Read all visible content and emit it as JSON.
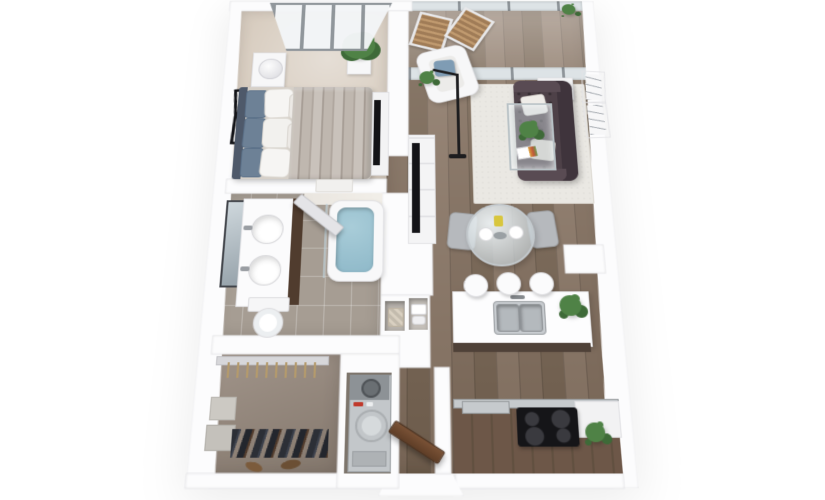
{
  "meta": {
    "description": "3D top-down floor plan rendering of a one-bedroom, one-bathroom apartment with balcony, walk-in closet, in-unit laundry and open kitchen-living area",
    "view": "bird's-eye 3D render on white background",
    "units_text_visible": "none"
  },
  "colors": {
    "wall": "#fcfcfd",
    "walledge": "#e4e4e8",
    "carpet": "#d8cdc0",
    "wood": "#84705f",
    "woodplank": "#796654",
    "woodlight": "#8d7968",
    "tile": "#a69d93",
    "closetfloor": "#94867a",
    "laundryfloor": "#7d756c",
    "rug": "#eae8e3",
    "sofa": "#4e4148",
    "sofaback": "#3f343c",
    "sofaarm": "#594b53",
    "pillowblue": "#7f9cb4",
    "water": "#8fb9c9",
    "vanity": "#503c2e",
    "counterwood": "#6d5748",
    "counterplank": "#615040",
    "cooktop": "#151518",
    "steel": "#c6cacd",
    "plant": "#4f8246",
    "plantdark": "#3e6a38",
    "doorwood": "#6e4a2f",
    "washer": "#c3c7ca",
    "glass": "#dde3e6",
    "mullion": "#8e9499",
    "headboard": "#4e596a",
    "cushion": "#6d8196",
    "duvet1": "#c9c2bb",
    "duvet2": "#a79e96",
    "offwhite": "#f7f7f8",
    "white": "#ffffff"
  },
  "rooms": [
    {
      "name": "bedroom",
      "floor": "beige carpet",
      "furniture": [
        "platform-bed",
        "upholstered-headboard",
        "pillows",
        "patterned-duvet",
        "nightstand",
        "table-lamp",
        "two-wall-frames",
        "potted-plant",
        "media-console-with-tv",
        "slanted-skylight-window",
        "foot-bench"
      ]
    },
    {
      "name": "bathroom",
      "floor": "gray tile",
      "furniture": [
        "double-sink-vanity",
        "leaning-mirror",
        "toilet",
        "soaking-tub-with-water",
        "glass-partition",
        "swing-door",
        "marble-wall-band"
      ]
    },
    {
      "name": "walk-in-closet",
      "floor": "taupe",
      "furniture": [
        "wire-shelf",
        "hangers",
        "storage-boxes",
        "hanging-clothes-row",
        "shoes"
      ]
    },
    {
      "name": "laundry-closet",
      "furniture": [
        "stacked-washer-dryer"
      ]
    },
    {
      "name": "hallway",
      "furniture": [
        "linen-niches",
        "woven-basket",
        "towel-stacks",
        "open-entry-door"
      ]
    },
    {
      "name": "balcony",
      "floor": "wood",
      "furniture": [
        "two-slat-chairs",
        "floor-to-ceiling-glazing",
        "glass-partition-door",
        "small-plant"
      ]
    },
    {
      "name": "living-room",
      "floor": "wood planks",
      "furniture": [
        "white-armchair",
        "blue-accent-pillow",
        "chesterfield-sofa",
        "two-sofa-pillows",
        "glass-coffee-table",
        "plant-centerpiece",
        "magazine",
        "area-rug",
        "tv-console-with-tv",
        "arc-floor-lamp",
        "shelf-unit",
        "two-wall-posters",
        "small-plant"
      ]
    },
    {
      "name": "dining-area",
      "furniture": [
        "round-glass-table",
        "two-gray-chairs",
        "two-plates",
        "yellow-pitcher",
        "center-bowl"
      ]
    },
    {
      "name": "kitchen",
      "furniture": [
        "white-island",
        "double-basin-sink",
        "faucet",
        "three-bar-stools",
        "island-plant",
        "wood-counter",
        "steel-trim",
        "black-cooktop",
        "counter-plant",
        "partition-stub-wall"
      ]
    }
  ]
}
